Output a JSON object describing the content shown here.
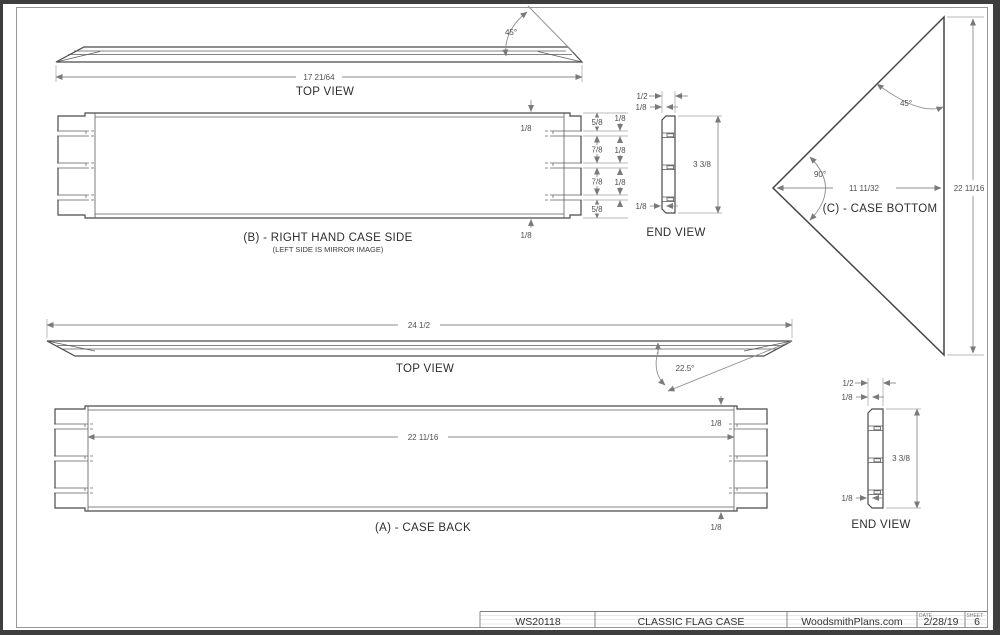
{
  "drawing": {
    "top_view_side": {
      "name": "TOP VIEW",
      "length": "17 21/64",
      "bevel_angle": "45°"
    },
    "case_side": {
      "name": "(B) - RIGHT HAND CASE SIDE",
      "note": "(LEFT SIDE IS MIRROR IMAGE)",
      "lip_top": "1/8",
      "lip_bottom": "1/8",
      "seg_top": "5/8",
      "seg_mid1": "7/8",
      "seg_mid2": "7/8",
      "seg_bottom": "5/8",
      "slot1": "1/8",
      "slot2": "1/8",
      "slot3": "1/8"
    },
    "end_view_side": {
      "name": "END VIEW",
      "thickness": "1/2",
      "rabbet_top": "1/8",
      "height": "3 3/8",
      "rabbet_bottom": "1/8"
    },
    "case_bottom": {
      "name": "(C) - CASE BOTTOM",
      "angle_hyp": "45°",
      "angle_apex": "90°",
      "depth": "11 11/32",
      "height": "22 11/16"
    },
    "top_view_back": {
      "name": "TOP VIEW",
      "length": "24 1/2",
      "bevel_angle": "22.5°"
    },
    "case_back": {
      "name": "(A) - CASE BACK",
      "inner_length": "22 11/16",
      "lip_top": "1/8",
      "lip_bottom": "1/8"
    },
    "end_view_back": {
      "name": "END VIEW",
      "thickness": "1/2",
      "rabbet_top": "1/8",
      "height": "3 3/8",
      "rabbet_bottom": "1/8"
    }
  },
  "title_block": {
    "plan_number": "WS20118",
    "plan_title": "CLASSIC FLAG CASE",
    "publisher": "WoodsmithPlans.com",
    "date_label": "DATE",
    "date_value": "2/28/19",
    "sheet_label": "SHEET",
    "sheet_value": "6"
  },
  "colors": {
    "frame": "#3e3e3e",
    "outline": "#4a4a4a",
    "dim_line": "#8e8e8e",
    "paper": "#ffffff"
  }
}
